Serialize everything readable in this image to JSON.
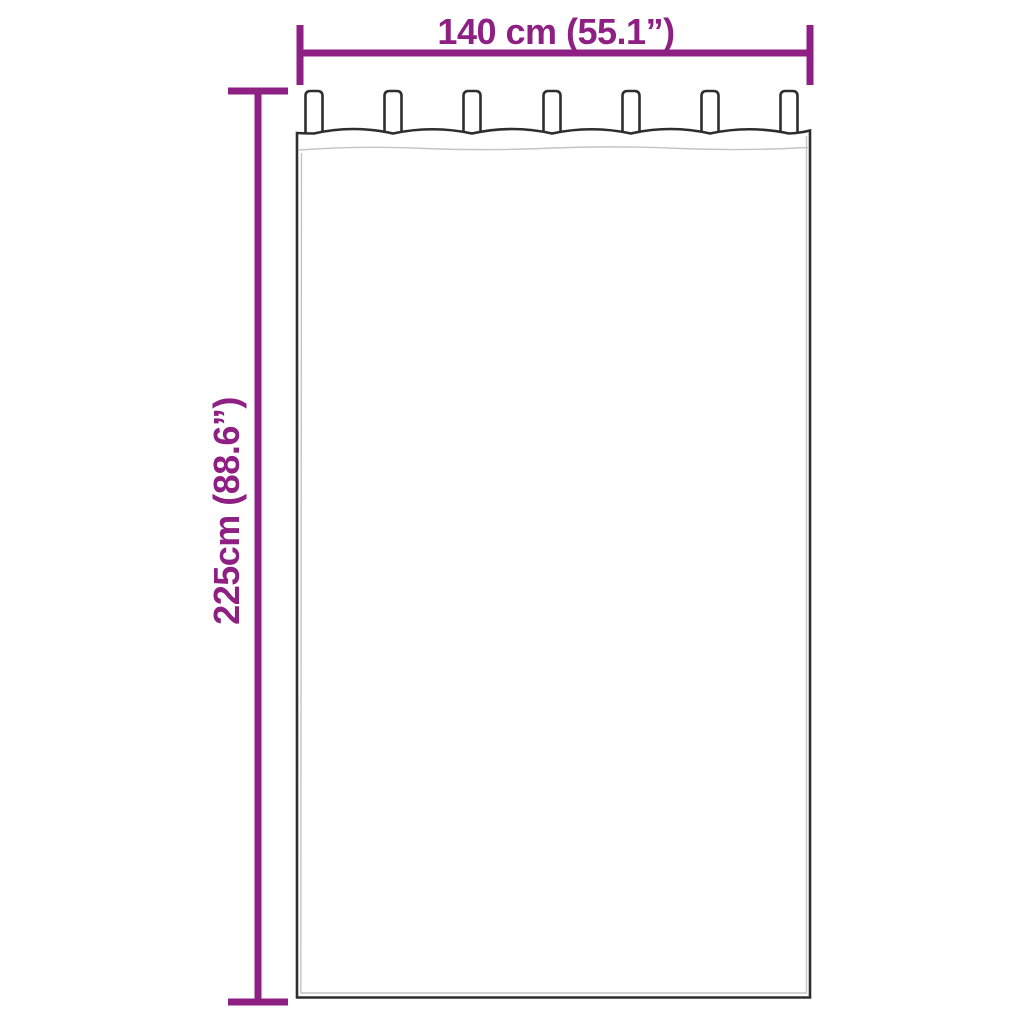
{
  "diagram": {
    "type": "product-dimension-diagram",
    "width_dimension": {
      "label": "140 cm (55.1”)",
      "value_cm": 140,
      "value_inches": 55.1
    },
    "height_dimension": {
      "label": "225cm (88.6”)",
      "value_cm": 225,
      "value_inches": 88.6
    },
    "curtain": {
      "tabs_count": 7
    },
    "colors": {
      "accent": "#8e1f83",
      "outline": "#2e2e2e",
      "seam": "#c4c4c4",
      "background": "#ffffff"
    }
  }
}
